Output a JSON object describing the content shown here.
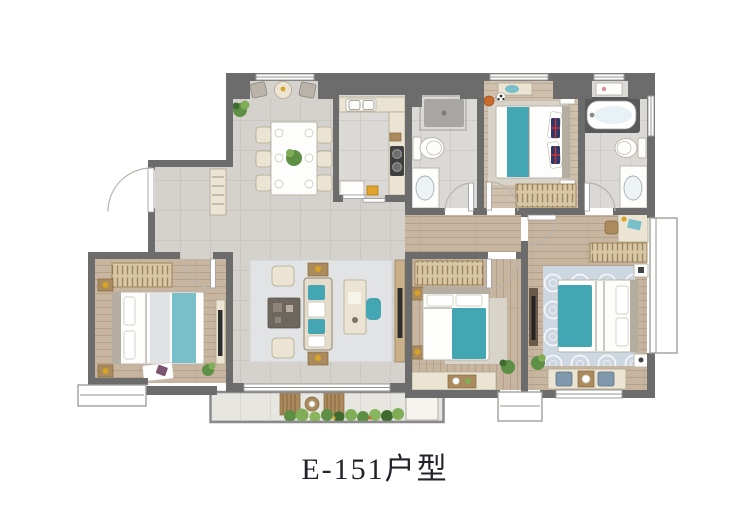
{
  "title": "E-151户型",
  "figure": {
    "kind": "apartment-floor-plan",
    "unit_code": "E-151",
    "type_suffix": "户型"
  },
  "colors": {
    "wall": "#6c6c6c",
    "tile": "#d5d2cd",
    "bath_tile": "#dbd9d5",
    "wood": "#c7b5a0",
    "wood_light": "#cfc0ad",
    "balcony": "#e8e6e1",
    "rug": "#e1e3e4",
    "rug_blue": "#cdd7e1",
    "furniture_beige": "#ebe4d3",
    "furniture_wood": "#ab8a5e",
    "wardrobe": "#d8c7a5",
    "accent_teal": "#43a6b2",
    "accent_teal_light": "#79bfca",
    "plant_green": "#5d8f45",
    "gold": "#d7a427",
    "title_text": "#23232c"
  },
  "rooms": [
    {
      "name": "entry-foyer",
      "furniture": [
        "entry-door",
        "shoe-cabinet"
      ]
    },
    {
      "name": "dining-area",
      "furniture": [
        "dining-table",
        "dining-chairs-x6",
        "plant",
        "window-nook-chairs"
      ]
    },
    {
      "name": "kitchen",
      "furniture": [
        "counter",
        "double-sink",
        "cooktop",
        "appliance"
      ]
    },
    {
      "name": "shared-bathroom",
      "furniture": [
        "shower",
        "toilet",
        "vanity-sink"
      ]
    },
    {
      "name": "bedroom-north",
      "furniture": [
        "double-bed",
        "wardrobe",
        "nightstands",
        "basketball",
        "football"
      ]
    },
    {
      "name": "master-bathroom",
      "furniture": [
        "bathtub",
        "toilet",
        "vanity-sink"
      ]
    },
    {
      "name": "living-room",
      "furniture": [
        "sofa",
        "coffee-table",
        "armchairs-x2",
        "side-tables",
        "desk",
        "desk-chair",
        "tv-cabinet"
      ]
    },
    {
      "name": "bedroom-west",
      "furniture": [
        "double-bed",
        "wardrobe",
        "nightstands",
        "tv-cabinet",
        "rug"
      ]
    },
    {
      "name": "bedroom-south",
      "furniture": [
        "double-bed",
        "wardrobe",
        "nightstands",
        "bay-window-ledge",
        "plant"
      ]
    },
    {
      "name": "master-bedroom",
      "furniture": [
        "double-bed",
        "wardrobe",
        "desk",
        "desk-chair",
        "tv-cabinet",
        "window-seat",
        "plant"
      ]
    },
    {
      "name": "balcony",
      "furniture": [
        "lounger-x2",
        "round-table",
        "planter-row"
      ]
    },
    {
      "name": "corridor",
      "furniture": []
    }
  ]
}
